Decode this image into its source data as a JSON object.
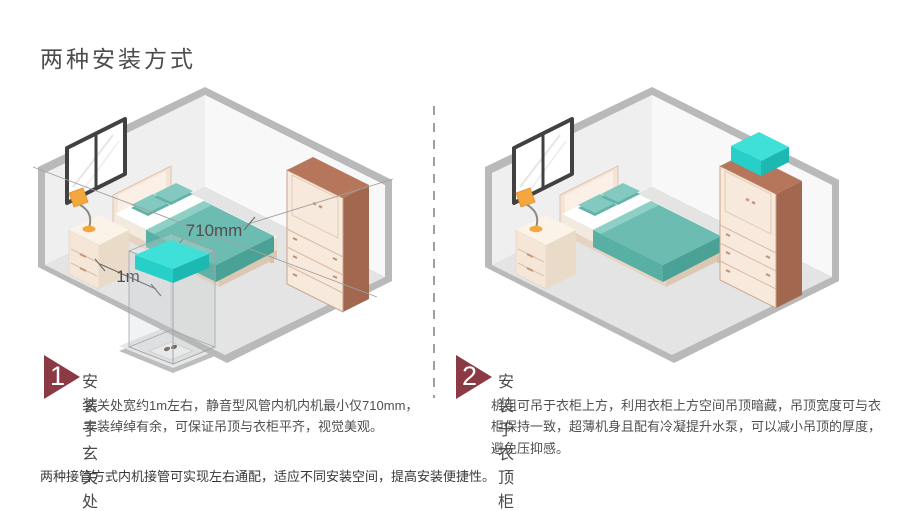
{
  "page": {
    "title": "两种安装方式",
    "footer_note": "两种接管方式内机接管可实现左右通配，适应不同安装空间，提高安装便捷性。"
  },
  "colors": {
    "accent_maroon": "#8B3A44",
    "divider_dash": "#A79B9E",
    "unit_cyan": "#3FE0D8",
    "bed_teal": "#6CBCB1",
    "wood_brown": "#A2674F",
    "cabinet_cream": "#F7E9DC",
    "floor_gray": "#E4E4E4",
    "lamp_orange": "#F3A73E",
    "text_dark": "#4A4A4A"
  },
  "sections": [
    {
      "number": "1",
      "title": "安装于玄关处",
      "description": "玄关处宽约1m左右，静音型风管内机内机最小仅710mm，安装绰绰有余，可保证吊顶与衣柜平齐，视觉美观。"
    },
    {
      "number": "2",
      "title": "安装于衣顶柜",
      "description": "机组可吊于衣柜上方，利用衣柜上方空间吊顶暗藏，吊顶宽度可与衣柜保持一致，超薄机身且配有冷凝提升水泵，可以减小吊顶的厚度，避免压抑感。"
    }
  ],
  "diagram_labels": {
    "unit_width": "710mm",
    "entry_width": "1m"
  }
}
